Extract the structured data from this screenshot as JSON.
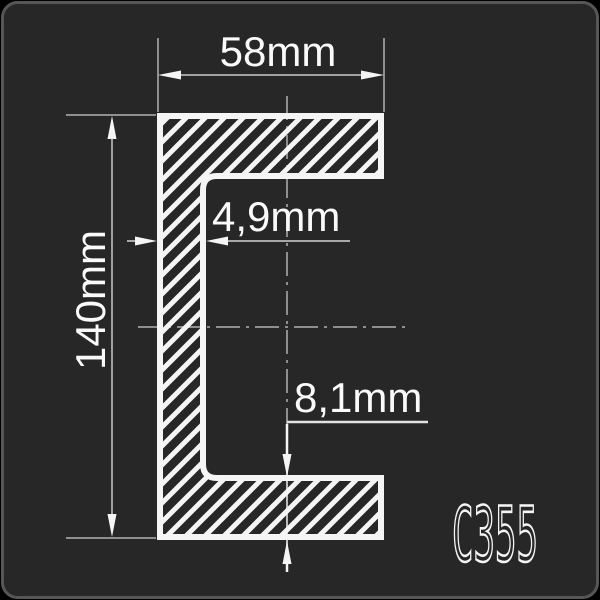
{
  "panel": {
    "background": "#272727",
    "border_color": "#565656"
  },
  "drawing": {
    "dimensions": {
      "width": "58mm",
      "height": "140mm",
      "web_thickness": "4,9mm",
      "flange_thickness": "8,1mm"
    },
    "badge": "C355",
    "colors": {
      "outline": "#f5f5f5",
      "hatch": "#f5f5f5",
      "dimension_line": "#a0a0a0",
      "extension_line": "#8f8f8f",
      "centerline": "#8f8f8f",
      "label_text": "#fafafa"
    }
  }
}
